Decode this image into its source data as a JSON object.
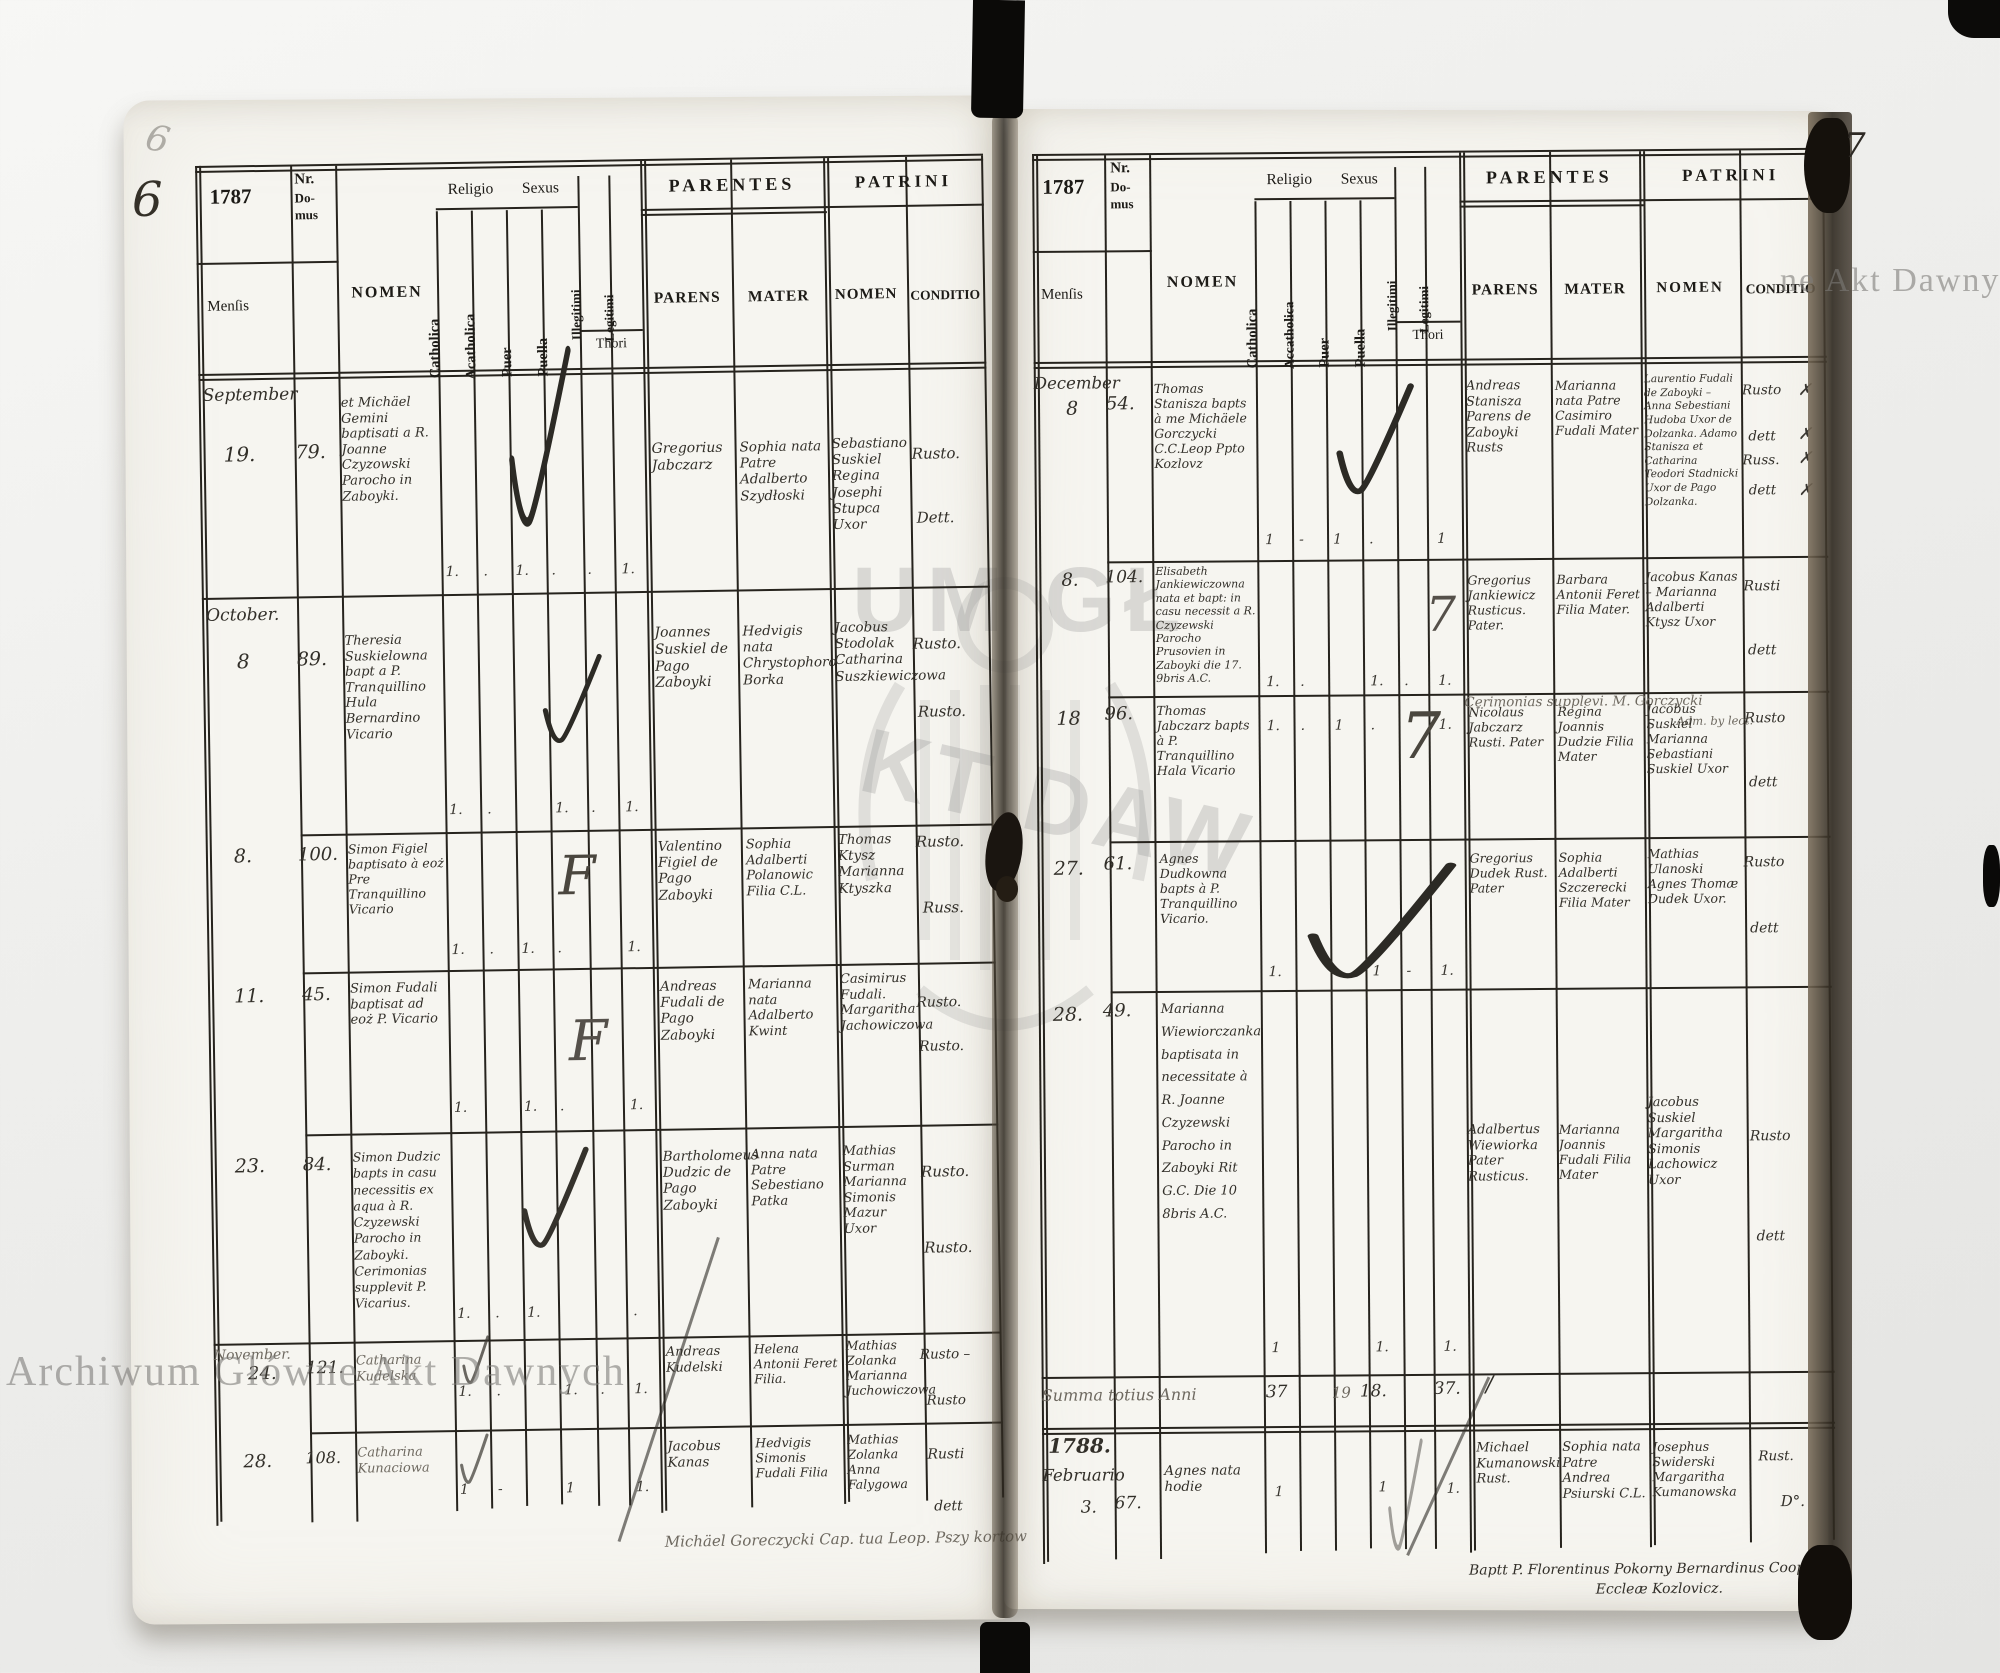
{
  "archive_watermark": {
    "bottom_left": "Archiwum Główne Akt Dawnych",
    "right_edge": "ne Akt Dawnych",
    "emblem_top": "UM GŁ",
    "emblem_bottom": "KT DAW"
  },
  "page_left": {
    "folio": "6",
    "header": {
      "year": "1787",
      "nr_line1": "Nr.",
      "nr_line2": "Do-",
      "nr_line3": "mus",
      "mensis": "Menſis",
      "nomen": "NOMEN",
      "religio": "Religio",
      "sexus": "Sexus",
      "catholica": "Catholica",
      "acatholica": "Acatholica",
      "puer": "Puer",
      "puella": "Puella",
      "illegitimi": "Illegitimi",
      "legitimi": "Legitimi",
      "thori": "Thori",
      "parentes": "PARENTES",
      "patrini": "PATRINI",
      "parens": "PARENS",
      "mater": "MATER",
      "patrini_nomen": "NOMEN",
      "conditio": "CONDITIO"
    },
    "entries": [
      {
        "month": "September",
        "day": "19.",
        "nr": "79.",
        "nomen": "et Michäel Gemini baptisati a R. Joanne Czyzowski Parocho in Zaboyki.",
        "marks": {
          "catholica": "1.",
          "acatholica": ".",
          "puer": "1.",
          "puella": ".",
          "illegitimi": ".",
          "legitimi": "1."
        },
        "parens": "Gregorius Jabczarz",
        "mater": "Sophia nata Patre Adalberto Szydłoski",
        "patrini": "Sebastiano Suskiel Regina Josephi Stupca Uxor",
        "conditio": [
          "Rusto.",
          "Dett."
        ]
      },
      {
        "month": "October.",
        "day": "8",
        "nr": "89.",
        "nomen": "Theresia Suskielowna bapt a P. Tranquillino Hula Bernardino Vicario",
        "marks": {
          "catholica": "1.",
          "acatholica": ".",
          "puella": "1.",
          "illegitimi": ".",
          "legitimi": "1."
        },
        "parens": "Joannes Suskiel de Pago Zaboyki",
        "mater": "Hedvigis nata Chrystophoro Borka",
        "patrini": "Jacobus Stodolak Catharina Suszkiewiczowa",
        "conditio": [
          "Rusto.",
          "Rusto."
        ]
      },
      {
        "day": "8.",
        "nr": "100.",
        "nomen": "Simon Figiel baptisato à eoż Pre Tranquillino Vicario",
        "marks": {
          "catholica": "1.",
          "acatholica": ".",
          "puer": "1.",
          "puella": ".",
          "legitimi": "1.",
          "thori": "F"
        },
        "parens": "Valentino Figiel de Pago Zaboyki",
        "mater": "Sophia Adalberti Polanowic Filia C.L.",
        "patrini": "Thomas Ktysz Marianna Ktyszka",
        "conditio": [
          "Rusto.",
          "Russ."
        ]
      },
      {
        "day": "11.",
        "nr": "45.",
        "nomen": "Simon Fudali baptisat ad eoż P. Vicario",
        "marks": {
          "catholica": "1.",
          "puer": "1.",
          "puella": ".",
          "legitimi": "1.",
          "thori": "F"
        },
        "parens": "Andreas Fudali de Pago Zaboyki",
        "mater": "Marianna nata Adalberto Kwint",
        "patrini": "Casimirus Fudali. Margaritha Jachowiczowa",
        "conditio": [
          "Rusto.",
          "Rusto."
        ]
      },
      {
        "day": "23.",
        "nr": "84.",
        "nomen": "Simon Dudzic bapts in casu necessitis ex aqua à R. Czyzewski Parocho in Zaboyki. Cerimonias supplevit P. Vicarius.",
        "marks": {
          "catholica": "1.",
          "acatholica": ".",
          "puer": "1.",
          "legitimi": "."
        },
        "parens": "Bartholomeus Dudzic de Pago Zaboyki",
        "mater": "Anna nata Patre Sebestiano Patka",
        "patrini": "Mathias Surman Marianna Simonis Mazur Uxor",
        "conditio": [
          "Rusto.",
          "Rusto."
        ]
      },
      {
        "month": "November.",
        "day": "24.",
        "nr": "121.",
        "nomen": "Catharina Kudelska",
        "marks": {
          "catholica": "1.",
          "acatholica": ".",
          "puella": "1.",
          "illegitimi": ".",
          "legitimi": "1."
        },
        "parens": "Andreas Kudelski",
        "mater": "Helena Antonii Feret Filia.",
        "patrini": "Mathias Zolanka Marianna Juchowiczowa",
        "conditio": [
          "Rusto –",
          "Rusto"
        ]
      },
      {
        "day": "28.",
        "nr": "108.",
        "nomen": "Catharina Kunaciowa",
        "marks": {
          "catholica": "1",
          "acatholica": "-",
          "puella": "1",
          "legitimi": "1."
        },
        "parens": "Jacobus Kanas",
        "mater": "Hedvigis Simonis Fudali Filia",
        "patrini": "Mathias Zolanka Anna Falygowa",
        "conditio": [
          "Rusti",
          "dett"
        ]
      }
    ],
    "footer_note": "Michäel Goreczycki Cap. tua Leop. Pszy kortow"
  },
  "page_right": {
    "folio": "7",
    "header": {
      "year": "1787",
      "nr_line1": "Nr.",
      "nr_line2": "Do-",
      "nr_line3": "mus",
      "mensis": "Menſis",
      "nomen": "NOMEN",
      "religio": "Religio",
      "sexus": "Sexus",
      "catholica": "Catholica",
      "acatholica": "Accatholica",
      "puer": "Puer",
      "puella": "Puella",
      "illegitimi": "Illegitimi",
      "legitimi": "Legitimi",
      "thori": "Thori",
      "parentes": "PARENTES",
      "patrini": "PATRINI",
      "parens": "PARENS",
      "mater": "MATER",
      "patrini_nomen": "NOMEN",
      "conditio": "CONDITIO"
    },
    "entries": [
      {
        "month": "December",
        "day": "8",
        "nr": "54.",
        "nomen": "Thomas Stanisza bapts à me Michäele Gorczycki C.C.Leop Ppto Kozlovz",
        "marks": {
          "catholica": "1",
          "acatholica": "-",
          "puer": "1",
          "puella": ".",
          "legitimi": "1"
        },
        "parens": "Andreas Stanisza Parens de Zaboyki Rusts",
        "mater": "Marianna nata Patre Casimiro Fudali Mater",
        "patrini": "Laurentio Fudali de Zaboyki – Anna Sebestiani Hudoba Uxor de Dolzanka. Adamo Stanisza et Catharina Teodori Stadnicki Uxor de Pago Dolzanka.",
        "conditio": [
          "Rusto",
          "dett",
          "Russ.",
          "dett"
        ],
        "xmarks": [
          "✗",
          "✗",
          "✗",
          "✗"
        ]
      },
      {
        "day": "8.",
        "nr": "104.",
        "nomen": "Elisabeth Jankiewiczowna nata et bapt: in casu necessit a R. Czyzewski Parocho Prusovien in Zaboyki die 17. 9bris A.C.",
        "marks": {
          "catholica": "1.",
          "acatholica": ".",
          "puella": "1.",
          "illegitimi": ".",
          "legitimi": "1.",
          "thori": "7"
        },
        "parens": "Gregorius Jankiewicz Rusticus. Pater.",
        "mater": "Barbara Antonii Feret Filia Mater.",
        "patrini": "Jacobus Kanas – Marianna Adalberti Ktysz Uxor",
        "conditio": [
          "Rusti",
          "dett"
        ],
        "note": "Cerimonias supplevi. M. Gorczycki",
        "note2": "Adm. by lect."
      },
      {
        "day": "18",
        "nr": "96.",
        "nomen": "Thomas Jabczarz bapts à P. Tranquillino Hala Vicario",
        "marks": {
          "catholica": "1.",
          "acatholica": ".",
          "puer": "1",
          "puella": ".",
          "legitimi": "1.",
          "thori": "7"
        },
        "parens": "Nicolaus Jabczarz Rusti. Pater",
        "mater": "Regina Joannis Dudzie Filia Mater",
        "patrini": "Jacobus Suskiel Marianna Sebastiani Suskiel Uxor",
        "conditio": [
          "Rusto",
          "dett"
        ]
      },
      {
        "day": "27.",
        "nr": "61.",
        "nomen": "Agnes Dudkowna bapts à P. Tranquillino Vicario.",
        "marks": {
          "catholica": "1.",
          "puella": "1",
          "illegitimi": "-",
          "legitimi": "1."
        },
        "parens": "Gregorius Dudek Rust. Pater",
        "mater": "Sophia Adalberti Szczerecki Filia Mater",
        "patrini": "Mathias Ulanoski Agnes Thomæ Dudek Uxor.",
        "conditio": [
          "Rusto",
          "dett"
        ]
      },
      {
        "day": "28.",
        "nr": "49.",
        "nomen": "Marianna Wiewiorczanka baptisata in necessitate à R. Joanne Czyzewski Parocho in Zaboyki Rit G.C. Die 10 8bris A.C.",
        "marks": {
          "catholica": "1",
          "puella": "1.",
          "legitimi": "1."
        },
        "parens": "Adalbertus Wiewiorka Pater Rusticus.",
        "mater": "Marianna Joannis Fudali Filia Mater",
        "patrini": "Jacobus Suskiel Margaritha Simonis Lachowicz Uxor",
        "conditio": [
          "Rusto",
          "dett"
        ]
      }
    ],
    "summa": {
      "label": "Summa totius Anni",
      "catholica": "37",
      "puer": "19",
      "puella": "18.",
      "legitimi": "37.",
      "slash": "/"
    },
    "entry_1788": {
      "year": "1788.",
      "month": "Februario",
      "day": "3.",
      "nr": "67.",
      "nomen": "Agnes nata hodie",
      "marks": {
        "catholica": "1",
        "puella": "1",
        "legitimi": "1."
      },
      "parens": "Michael Kumanowski Rust.",
      "mater": "Sophia nata Patre Andrea Psiurski C.L.",
      "patrini": "Josephus Swiderski Margaritha Kumanowska",
      "conditio": [
        "Rust.",
        "D°."
      ]
    },
    "footer_note": "Baptt P. Florentinus Pokorny Bernardinus Cooperator Eccleæ Kozlovicz."
  }
}
